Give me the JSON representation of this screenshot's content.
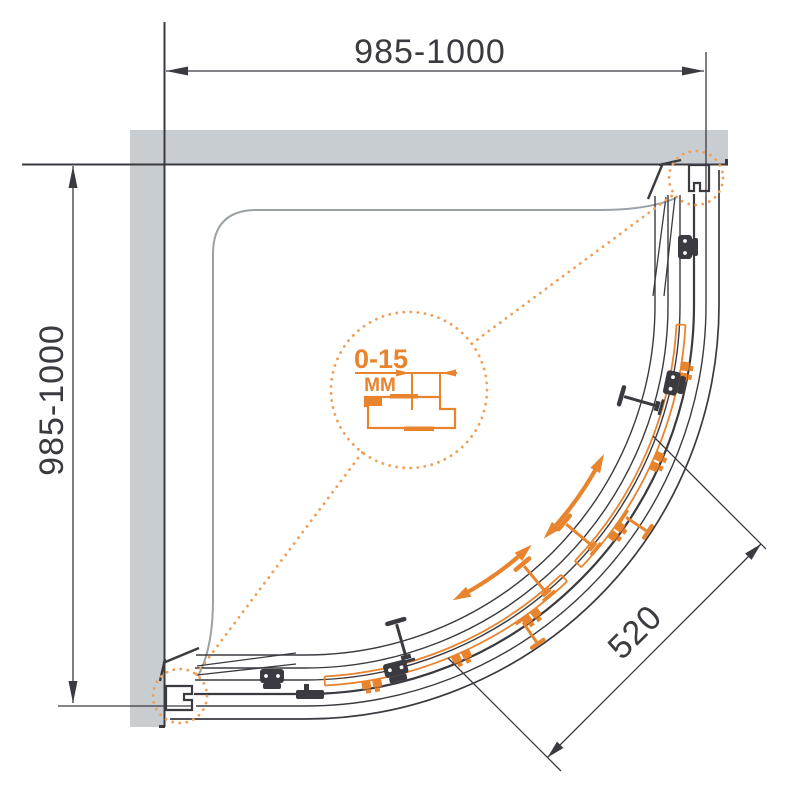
{
  "meta": {
    "title": "Quarter-round sliding shower enclosure - top view technical drawing"
  },
  "dimensions": {
    "width": "985-1000",
    "depth": "985-1000",
    "entry": "520"
  },
  "detail": {
    "range": "0-15",
    "unit": "MM"
  },
  "colors": {
    "accent": "#E8842E",
    "accent_dotted": "#EFA058",
    "wall": "#C8CDD2",
    "line": "#3A3A40",
    "tray_line": "#9AA1A7",
    "background": "#FFFFFF"
  }
}
